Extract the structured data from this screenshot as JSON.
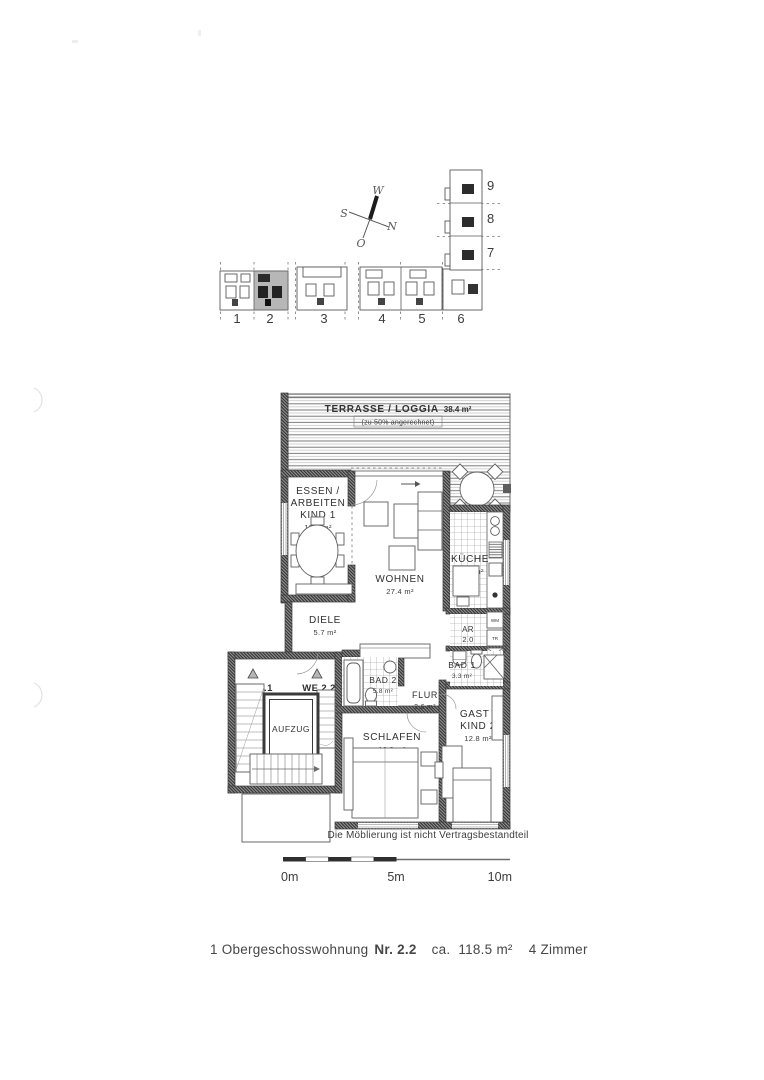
{
  "document": {
    "caption": {
      "part1": "1 Obergeschosswohnung",
      "nr": "Nr. 2.2",
      "ca": "ca.",
      "area": "118.5 m²",
      "zimmer": "4 Zimmer"
    },
    "furnishing_note": "Die Möblierung ist nicht Vertragsbestandteil"
  },
  "compass": {
    "west": "W",
    "south": "S",
    "north": "N",
    "east": "O"
  },
  "site_plan": {
    "units": [
      "1",
      "2",
      "3",
      "4",
      "5",
      "6"
    ],
    "wing_units": [
      "7",
      "8",
      "9"
    ]
  },
  "scale_bar": {
    "zero": "0m",
    "five": "5m",
    "ten": "10m"
  },
  "floor_plan": {
    "terrace": {
      "label": "TERRASSE / LOGGIA",
      "area": "38.4 m²",
      "note": "(zu 50% angerechnet)"
    },
    "essen": {
      "line1": "ESSEN /",
      "line2": "ARBEITEN",
      "line3": "KIND 1",
      "area": "12.2 m²"
    },
    "wohnen": {
      "label": "WOHNEN",
      "area": "27.4 m²"
    },
    "kueche": {
      "label": "KÜCHE",
      "area": "10.3 m²"
    },
    "diele": {
      "label": "DIELE",
      "area": "5.7 m²"
    },
    "abstellraum": {
      "label": "AR",
      "area": "2.0"
    },
    "bad1": {
      "label": "BAD 1",
      "area": "3.3 m²"
    },
    "bad2": {
      "label": "BAD 2",
      "area": "5.8 m²"
    },
    "flur": {
      "label": "FLUR",
      "area": "2.6 m²"
    },
    "schlafen": {
      "label": "SCHLAFEN",
      "area": "16.3 m²"
    },
    "gast": {
      "line1": "GAST /",
      "line2": "KIND 2",
      "area": "12.8 m²"
    },
    "we21": "WE 2.1",
    "we22": "WE 2.2",
    "aufzug": "AUFZUG",
    "wm": "WM",
    "tr": "TR"
  }
}
